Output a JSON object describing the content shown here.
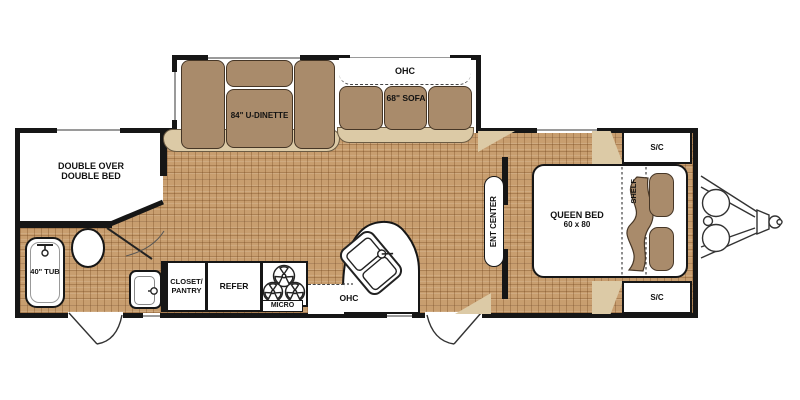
{
  "title": "Travel Trailer Floor Plan",
  "colors": {
    "floor": "#c89e6f",
    "furniture": "#a98b6b",
    "furniture_border": "#463626",
    "base_beige": "#dccaa6",
    "wall": "#161616",
    "window": "#9a9a9a"
  },
  "labels": {
    "front_bedroom_line1": "DOUBLE OVER",
    "front_bedroom_line2": "DOUBLE BED",
    "tub": "40\" TUB",
    "dinette": "84\" U-DINETTE",
    "ohc_dinette": "OHC",
    "sofa": "68\" SOFA",
    "closet_line1": "CLOSET/",
    "closet_line2": "PANTRY",
    "refer": "REFER",
    "micro": "MICRO",
    "ohc_kitchen": "OHC",
    "ent_center": "ENT CENTER",
    "queen_bed_line1": "QUEEN BED",
    "queen_bed_line2": "60 x 80",
    "shelf": "SHELF",
    "sc_front": "S/C",
    "sc_rear": "S/C"
  }
}
